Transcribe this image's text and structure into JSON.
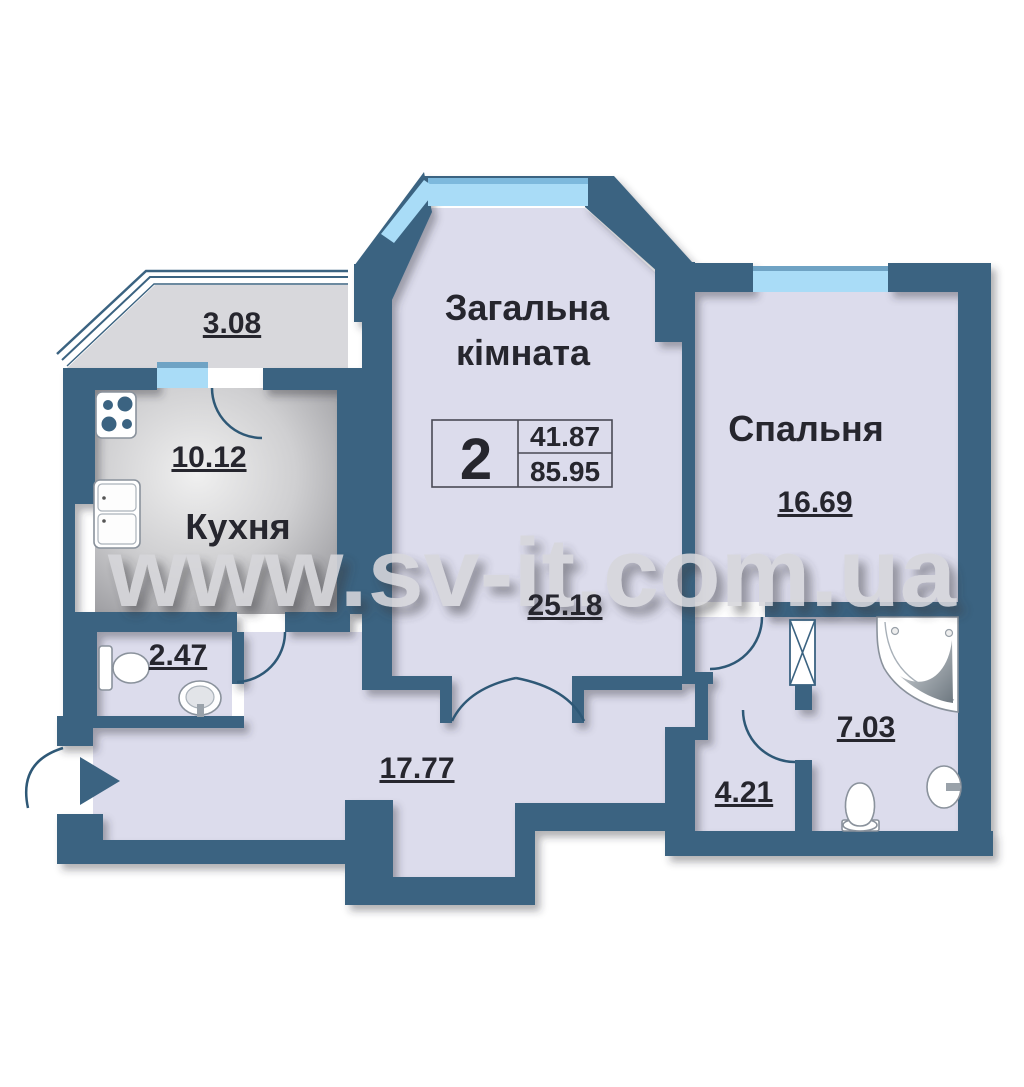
{
  "watermark": "www.sv-it.com.ua",
  "summary": {
    "rooms_count": "2",
    "living_area": "41.87",
    "total_area": "85.95"
  },
  "rooms": {
    "living": {
      "name_line1": "Загальна",
      "name_line2": "кімната",
      "area": "25.18"
    },
    "bedroom": {
      "name": "Спальня",
      "area": "16.69"
    },
    "kitchen": {
      "name": "Кухня",
      "area": "10.12"
    },
    "balcony": {
      "area": "3.08"
    },
    "wc": {
      "area": "2.47"
    },
    "hallway": {
      "area": "17.77"
    },
    "corridor": {
      "area": "4.21"
    },
    "bathroom": {
      "area": "7.03"
    }
  },
  "colors": {
    "wall": "#3b6381",
    "floor": "#dcdcec",
    "window": "#a9dcf7",
    "window_edge": "#6fa3c4",
    "kitchen_floor_light": "#efefef",
    "kitchen_floor_dark": "#9d9da1",
    "balcony_floor": "#d8d8dc",
    "text": "#26262e",
    "watermark": "#d7d7db"
  }
}
